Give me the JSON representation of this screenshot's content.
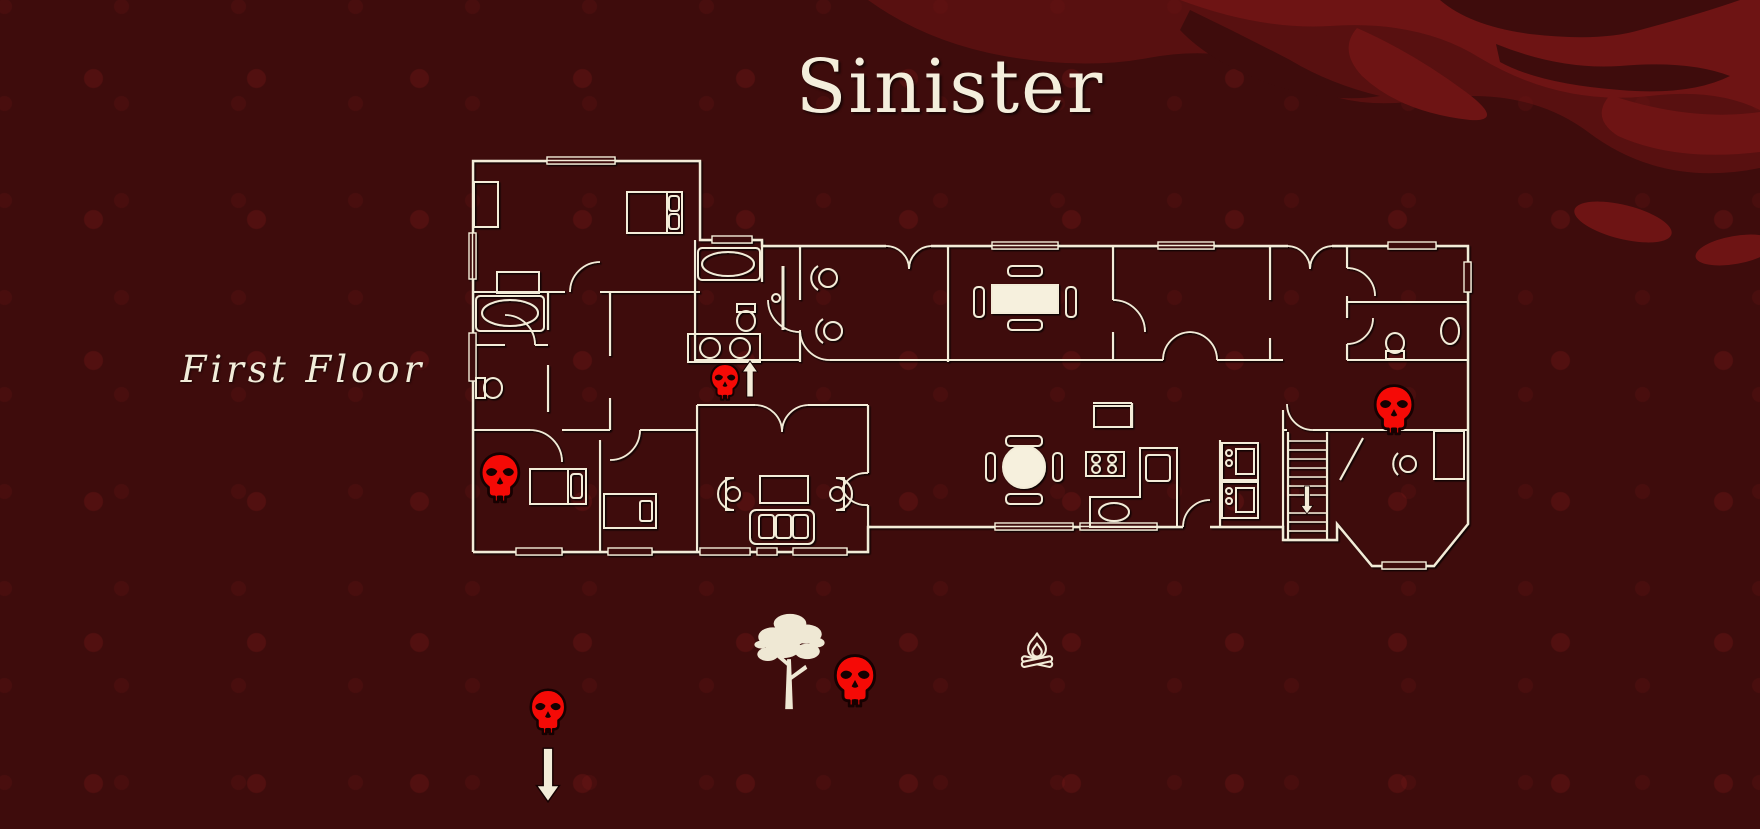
{
  "page": {
    "title": "Sinister",
    "floor_label": "First Floor"
  },
  "colors": {
    "background": "#3E0C0C",
    "splatter_red": "#6E1414",
    "plan_line_cream": "#F3ECD8",
    "skull_red": "#F50A06",
    "text_cream": "#F4EEDC"
  },
  "markers": {
    "skulls": [
      {
        "id": "hallway-skull",
        "x": 725,
        "y": 382,
        "w": 34,
        "h": 40
      },
      {
        "id": "bedroom-skull",
        "x": 500,
        "y": 478,
        "w": 46,
        "h": 54
      },
      {
        "id": "study-skull",
        "x": 1394,
        "y": 410,
        "w": 46,
        "h": 54
      },
      {
        "id": "yard-skull",
        "x": 855,
        "y": 681,
        "w": 48,
        "h": 56
      },
      {
        "id": "driveway-skull",
        "x": 548,
        "y": 712,
        "w": 42,
        "h": 50
      }
    ],
    "arrows": [
      {
        "id": "hallway-up-arrow",
        "x": 750,
        "y": 379,
        "dir": "up",
        "w": 17,
        "h": 36
      },
      {
        "id": "stairs-down-arrow",
        "x": 1307,
        "y": 500,
        "dir": "down",
        "w": 13,
        "h": 28
      },
      {
        "id": "driveway-down-arrow",
        "x": 548,
        "y": 775,
        "dir": "down",
        "w": 23,
        "h": 58
      }
    ],
    "tree": {
      "id": "yard-tree",
      "x": 790,
      "y": 661,
      "w": 78,
      "h": 100
    },
    "campfire": {
      "id": "yard-campfire",
      "x": 1037,
      "y": 650,
      "w": 38,
      "h": 38
    }
  }
}
